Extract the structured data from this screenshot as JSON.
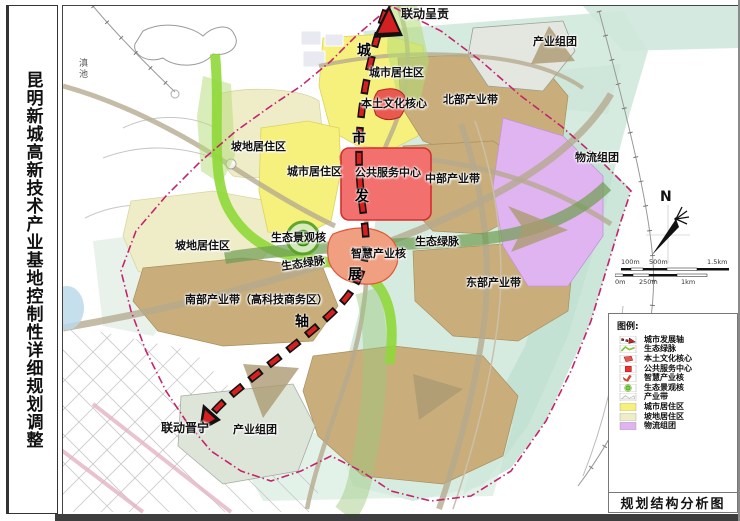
{
  "page": {
    "title_vertical": "昆明新城高新技术产业基地控制性详细规划调整"
  },
  "map": {
    "labels": {
      "dianchi": "滇池",
      "liandong_chenggong": "联动呈贡",
      "chanye_zutuan_ne": "产业组团",
      "chengshi_juzhuqu_n": "城市居住区",
      "bentu_wenhua_hexin": "本土文化核心",
      "beibu_chanyedai": "北部产业带",
      "podi_juzhuqu_n": "坡地居住区",
      "chengshi_juzhuqu_w": "城市居住区",
      "gonggong_fuwu_zhongxin": "公共服务中心",
      "zhongbu_chanyedai": "中部产业带",
      "wuliu_zutuan": "物流组团",
      "podi_juzhuqu_w": "坡地居住区",
      "shengtai_jingguan_he": "生态景观核",
      "shengtai_lvmai_e": "生态绿脉",
      "shengtai_lvmai_w": "生态绿脉",
      "zhihui_chanye_he": "智慧产业核",
      "dongbu_chanyedai": "东部产业带",
      "nanbu_chanyedai": "南部产业带（高科技商务区）",
      "liandong_jinning": "联动晋宁",
      "chanye_zutuan_s": "产业组团"
    },
    "axis_text": [
      "城",
      "市",
      "发",
      "展",
      "轴"
    ],
    "north_label": "N",
    "scalebar": {
      "top_labels": [
        "100m",
        "500m",
        "1.5km"
      ],
      "bottom_labels": [
        "0m",
        "250m",
        "1km"
      ]
    }
  },
  "legend": {
    "heading": "图例:",
    "items": [
      {
        "label": "城市发展轴"
      },
      {
        "label": "生态绿脉"
      },
      {
        "label": "本土文化核心"
      },
      {
        "label": "公共服务中心"
      },
      {
        "label": "智慧产业核"
      },
      {
        "label": "生态景观核"
      },
      {
        "label": "产业带"
      },
      {
        "label": "城市居住区",
        "color": "#f6f07c"
      },
      {
        "label": "坡地居住区",
        "color": "#efedc8"
      },
      {
        "label": "物流组团",
        "color": "#e0b4f0"
      }
    ]
  },
  "footer": {
    "map_title": "规划结构分析图"
  },
  "colors": {
    "axis_red": "#d42020",
    "boundary_pink": "#c4246e",
    "eco_green_bright": "#8fd838",
    "eco_green_dark": "#6f9e53",
    "residential_yellow": "#f6f07c",
    "slope_cream": "#efedc8",
    "industry_tan": "#c9ae7c",
    "logistics_purple": "#e0b4f0",
    "service_red": "#f2706e",
    "culture_red": "#e85a50",
    "smart_orange": "#f0a080",
    "mint_teal": "#cfe7db"
  }
}
